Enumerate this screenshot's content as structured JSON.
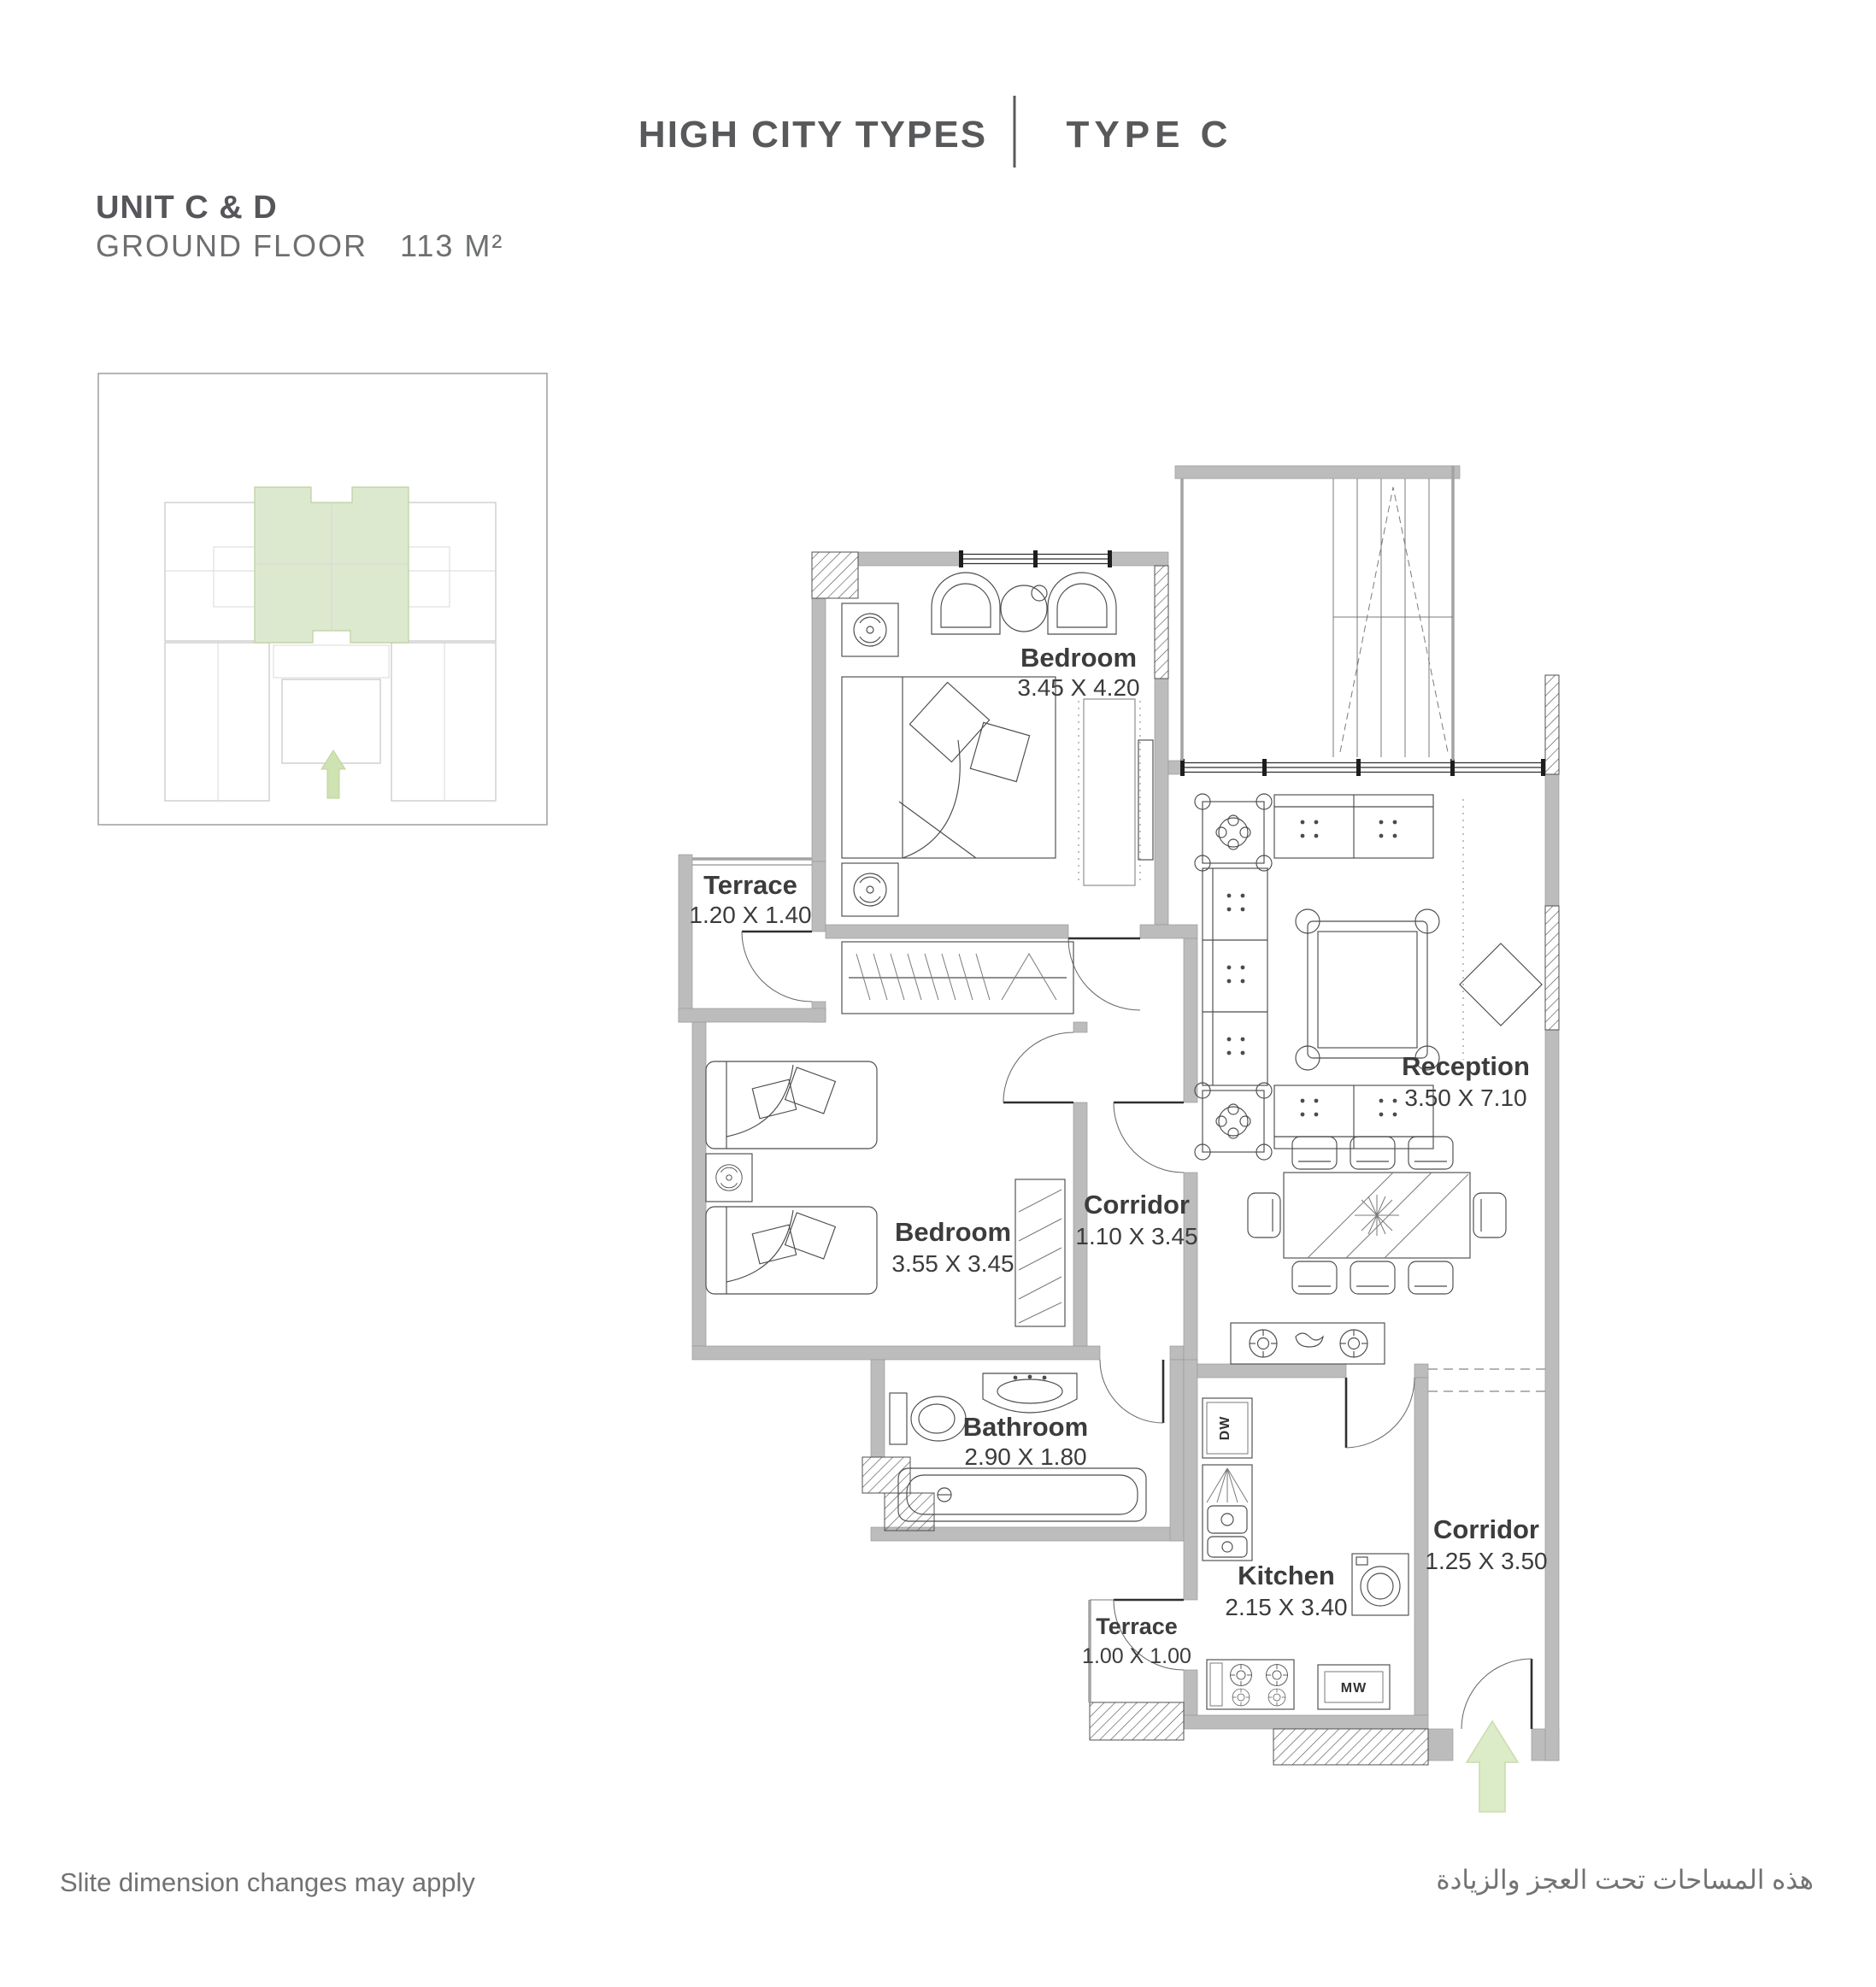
{
  "header": {
    "title": "HIGH CITY TYPES",
    "type_label": "TYPE C"
  },
  "unit_info": {
    "title": "UNIT C & D",
    "floor": "GROUND FLOOR",
    "area": "113 M²"
  },
  "floor_plan": {
    "rooms": [
      {
        "id": "bedroom-master",
        "name": "Bedroom",
        "dims": "3.45 X 4.20"
      },
      {
        "id": "reception",
        "name": "Reception",
        "dims": "3.50 X 7.10"
      },
      {
        "id": "terrace-1",
        "name": "Terrace",
        "dims": "1.20 X 1.40"
      },
      {
        "id": "bedroom-2",
        "name": "Bedroom",
        "dims": "3.55 X 3.45"
      },
      {
        "id": "corridor-1",
        "name": "Corridor",
        "dims": "1.10 X 3.45"
      },
      {
        "id": "bathroom",
        "name": "Bathroom",
        "dims": "2.90 X 1.80"
      },
      {
        "id": "kitchen",
        "name": "Kitchen",
        "dims": "2.15 X 3.40"
      },
      {
        "id": "terrace-2",
        "name": "Terrace",
        "dims": "1.00 X 1.00"
      },
      {
        "id": "corridor-2",
        "name": "Corridor",
        "dims": "1.25 X 3.50"
      }
    ],
    "appliances": {
      "dishwasher": "DW",
      "microwave": "MW"
    }
  },
  "footer": {
    "note_en": "Slite dimension changes may apply",
    "note_ar": "هذه المساحات تحت العجز والزيادة"
  },
  "colors": {
    "text": "#58595b",
    "label": "#3c3c3c",
    "wall": "#bcbcbc",
    "highlight_green": "#dde9cf",
    "arrow_green": "#dcebc8"
  }
}
